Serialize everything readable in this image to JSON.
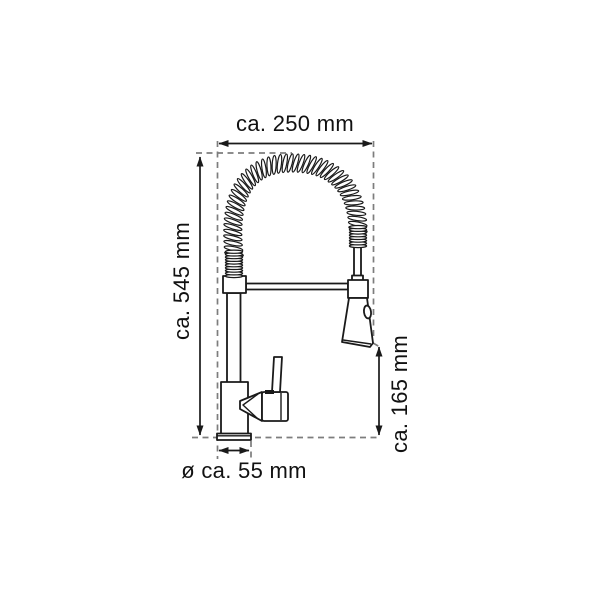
{
  "page": {
    "background": "#ffffff"
  },
  "diagram": {
    "line_color": "#1a1a1a",
    "dash_color": "#7d7d7d",
    "labels": {
      "width_top": "ca. 250 mm",
      "height_left": "ca. 545 mm",
      "height_right": "ca. 165 mm",
      "base_diameter": "ø ca. 55 mm"
    }
  }
}
